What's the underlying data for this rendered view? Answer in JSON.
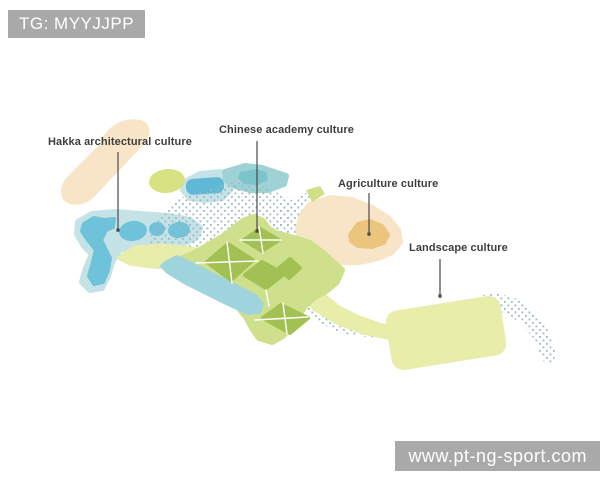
{
  "watermarks": {
    "top_left": {
      "text": "TG: MYYJJPP"
    },
    "bottom_right": {
      "text": "www.pt-ng-sport.com"
    }
  },
  "map": {
    "type": "masterplan-zone-diagram",
    "zones": [
      {
        "id": "hakka",
        "label": "Hakka architectural culture",
        "swatch": "#f8e5c8"
      },
      {
        "id": "academy",
        "label": "Chinese academy culture",
        "swatch": "#a3c153"
      },
      {
        "id": "agriculture",
        "label": "Agriculture culture",
        "swatch": "#ebc47e"
      },
      {
        "id": "landscape",
        "label": "Landscape culture",
        "swatch": "#e9edaa"
      }
    ],
    "palette": {
      "water_light": "#c5e2e6",
      "water_teal": "#9ed2d4",
      "water_dark": "#6ec3da",
      "dot_overlay": "#9bb9c2",
      "land_green": "#cfe08c",
      "plot_green": "#a3c153",
      "land_pale": "#e9edaa",
      "peach": "#f8e5c8",
      "tan_patch": "#ebc47e",
      "leader_line": "#4a4a4a",
      "label_text": "#3e3e3e",
      "watermark_bg": "#a9a9a9"
    }
  }
}
